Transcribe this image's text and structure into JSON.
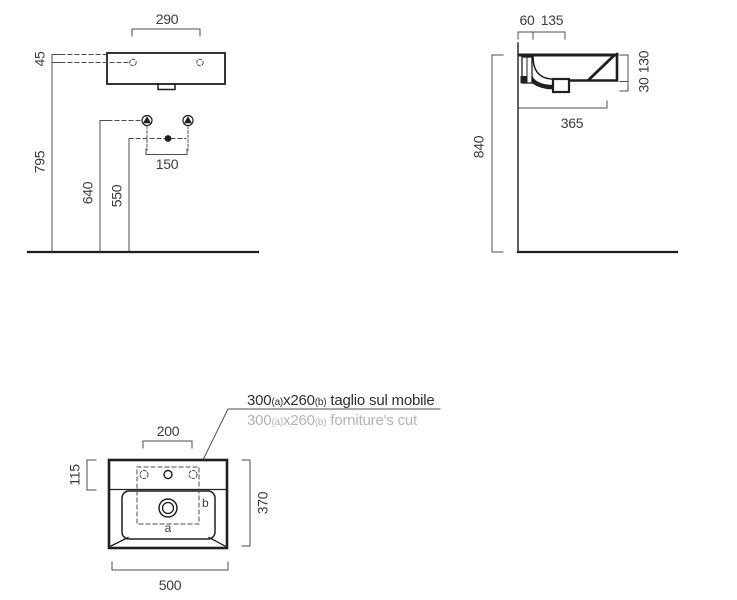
{
  "drawing": {
    "title": "washbasin-installation-technical-drawing",
    "colors": {
      "background": "#ffffff",
      "object_line": "#1f1f1f",
      "dimension_line": "#4c4c4c",
      "dimension_text": "#3c3c3c",
      "note_text": "#2f2f2f",
      "note_text_muted": "#b3b3b3"
    },
    "front_view": {
      "fixing_hole_spacing": "290",
      "rim_to_fixing_holes": "45",
      "floor_to_rim": "795",
      "floor_to_bracket": "640",
      "floor_to_drain": "550",
      "bracket_spacing": "150"
    },
    "side_view": {
      "wall_to_fixing": "60",
      "fixing_to_tap": "135",
      "basin_height": "130",
      "drain_height": "30",
      "basin_depth": "365",
      "floor_to_rim": "840"
    },
    "plan_view": {
      "tap_hole_spacing": "200",
      "rear_deck_depth": "115",
      "basin_depth": "370",
      "basin_width": "500",
      "cut_label_a": "a",
      "cut_label_b": "b",
      "note_italian": {
        "size_a": "300",
        "sub_a": "(a)",
        "size_b": "x260",
        "sub_b": "(b)",
        "caption": " taglio sul mobile"
      },
      "note_english": {
        "size_a": "300",
        "sub_a": "(a)",
        "size_b": "x260",
        "sub_b": "(b)",
        "caption": " forniture's cut"
      }
    }
  }
}
